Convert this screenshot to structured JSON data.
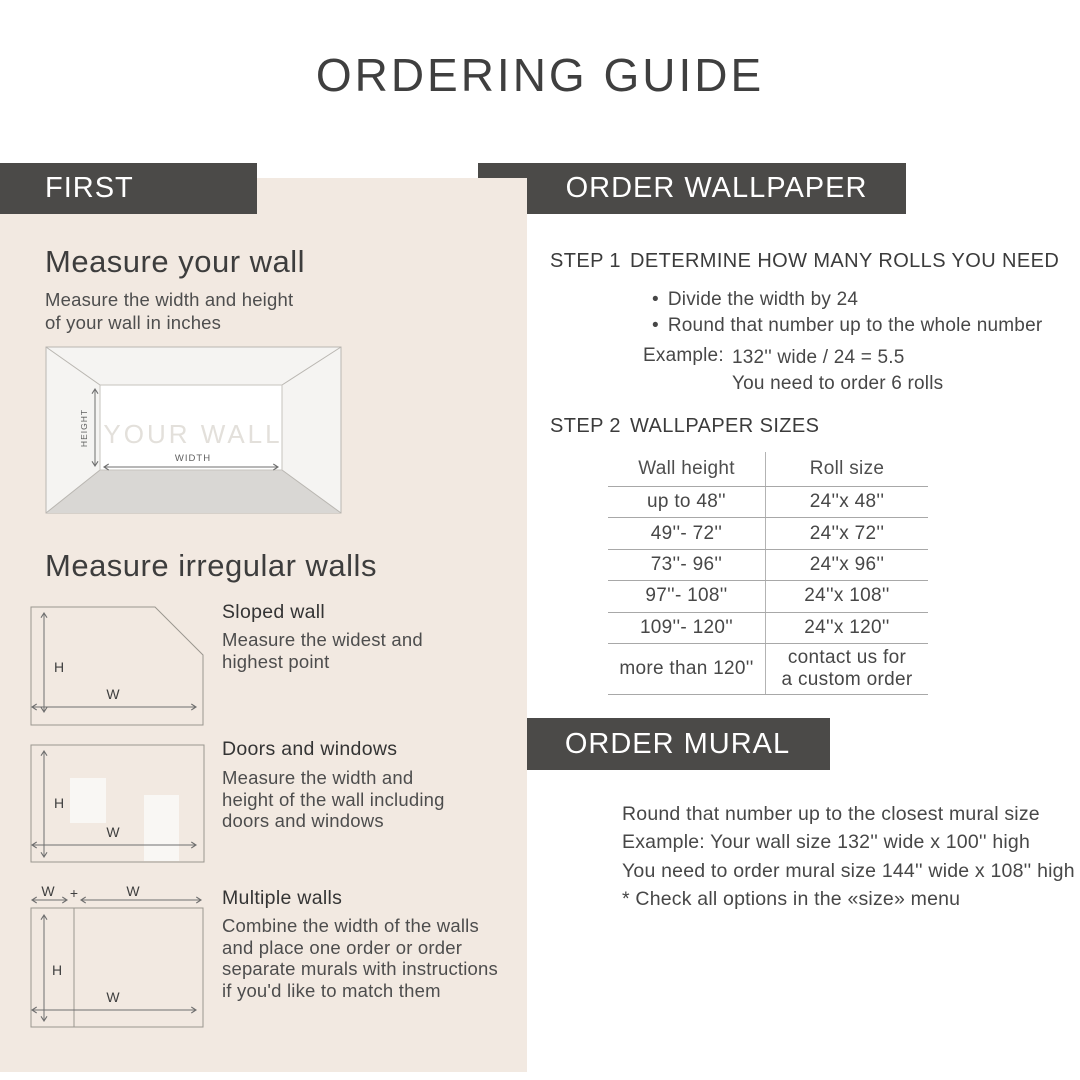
{
  "title": "ORDERING GUIDE",
  "colors": {
    "bar": "#4b4a48",
    "panel": "#f2e9e1",
    "text_dark": "#3d3d3d",
    "text_body": "#4e4e4e"
  },
  "left": {
    "header": "FIRST",
    "measure_wall": {
      "heading": "Measure your wall",
      "body": "Measure the width and height\nof your wall in inches",
      "diagram": {
        "label": "YOUR WALL",
        "height_label": "HEIGHT",
        "width_label": "WIDTH"
      }
    },
    "irregular": {
      "heading": "Measure irregular walls",
      "h_label": "H",
      "w_label": "W",
      "plus": "+",
      "items": [
        {
          "title": "Sloped wall",
          "body": "Measure the widest and\nhighest point"
        },
        {
          "title": "Doors and windows",
          "body": "Measure the width and\nheight of the wall including\ndoors and windows"
        },
        {
          "title": "Multiple walls",
          "body": "Combine the width of the walls\nand place one order or order\nseparate murals with instructions\nif you'd like to match them"
        }
      ]
    }
  },
  "wallpaper": {
    "header": "ORDER WALLPAPER",
    "step1": {
      "label": "STEP 1",
      "heading": "DETERMINE HOW MANY ROLLS YOU NEED",
      "bullet_glyph": "•",
      "bullets": [
        "Divide the width by 24",
        "Round that number up to the whole number"
      ],
      "example_label": "Example:",
      "example_line1": "132'' wide / 24 = 5.5",
      "example_line2": "You need to order 6 rolls"
    },
    "step2": {
      "label": "STEP 2",
      "heading": "WALLPAPER SIZES"
    },
    "table": {
      "columns": [
        "Wall height",
        "Roll size"
      ],
      "rows": [
        [
          "up to 48''",
          "24''x 48''"
        ],
        [
          "49''- 72''",
          "24''x 72''"
        ],
        [
          "73''- 96''",
          "24''x 96''"
        ],
        [
          "97''- 108''",
          "24''x 108''"
        ],
        [
          "109''- 120''",
          "24''x 120''"
        ],
        [
          "more than 120''",
          "contact us for\na custom order"
        ]
      ]
    }
  },
  "mural": {
    "header": "ORDER MURAL",
    "lines": [
      "Round that number up to the closest mural size",
      "Example: Your wall size 132'' wide x 100'' high",
      "You need to order mural size 144'' wide x 108'' high",
      "* Check all options in the «size» menu"
    ]
  }
}
